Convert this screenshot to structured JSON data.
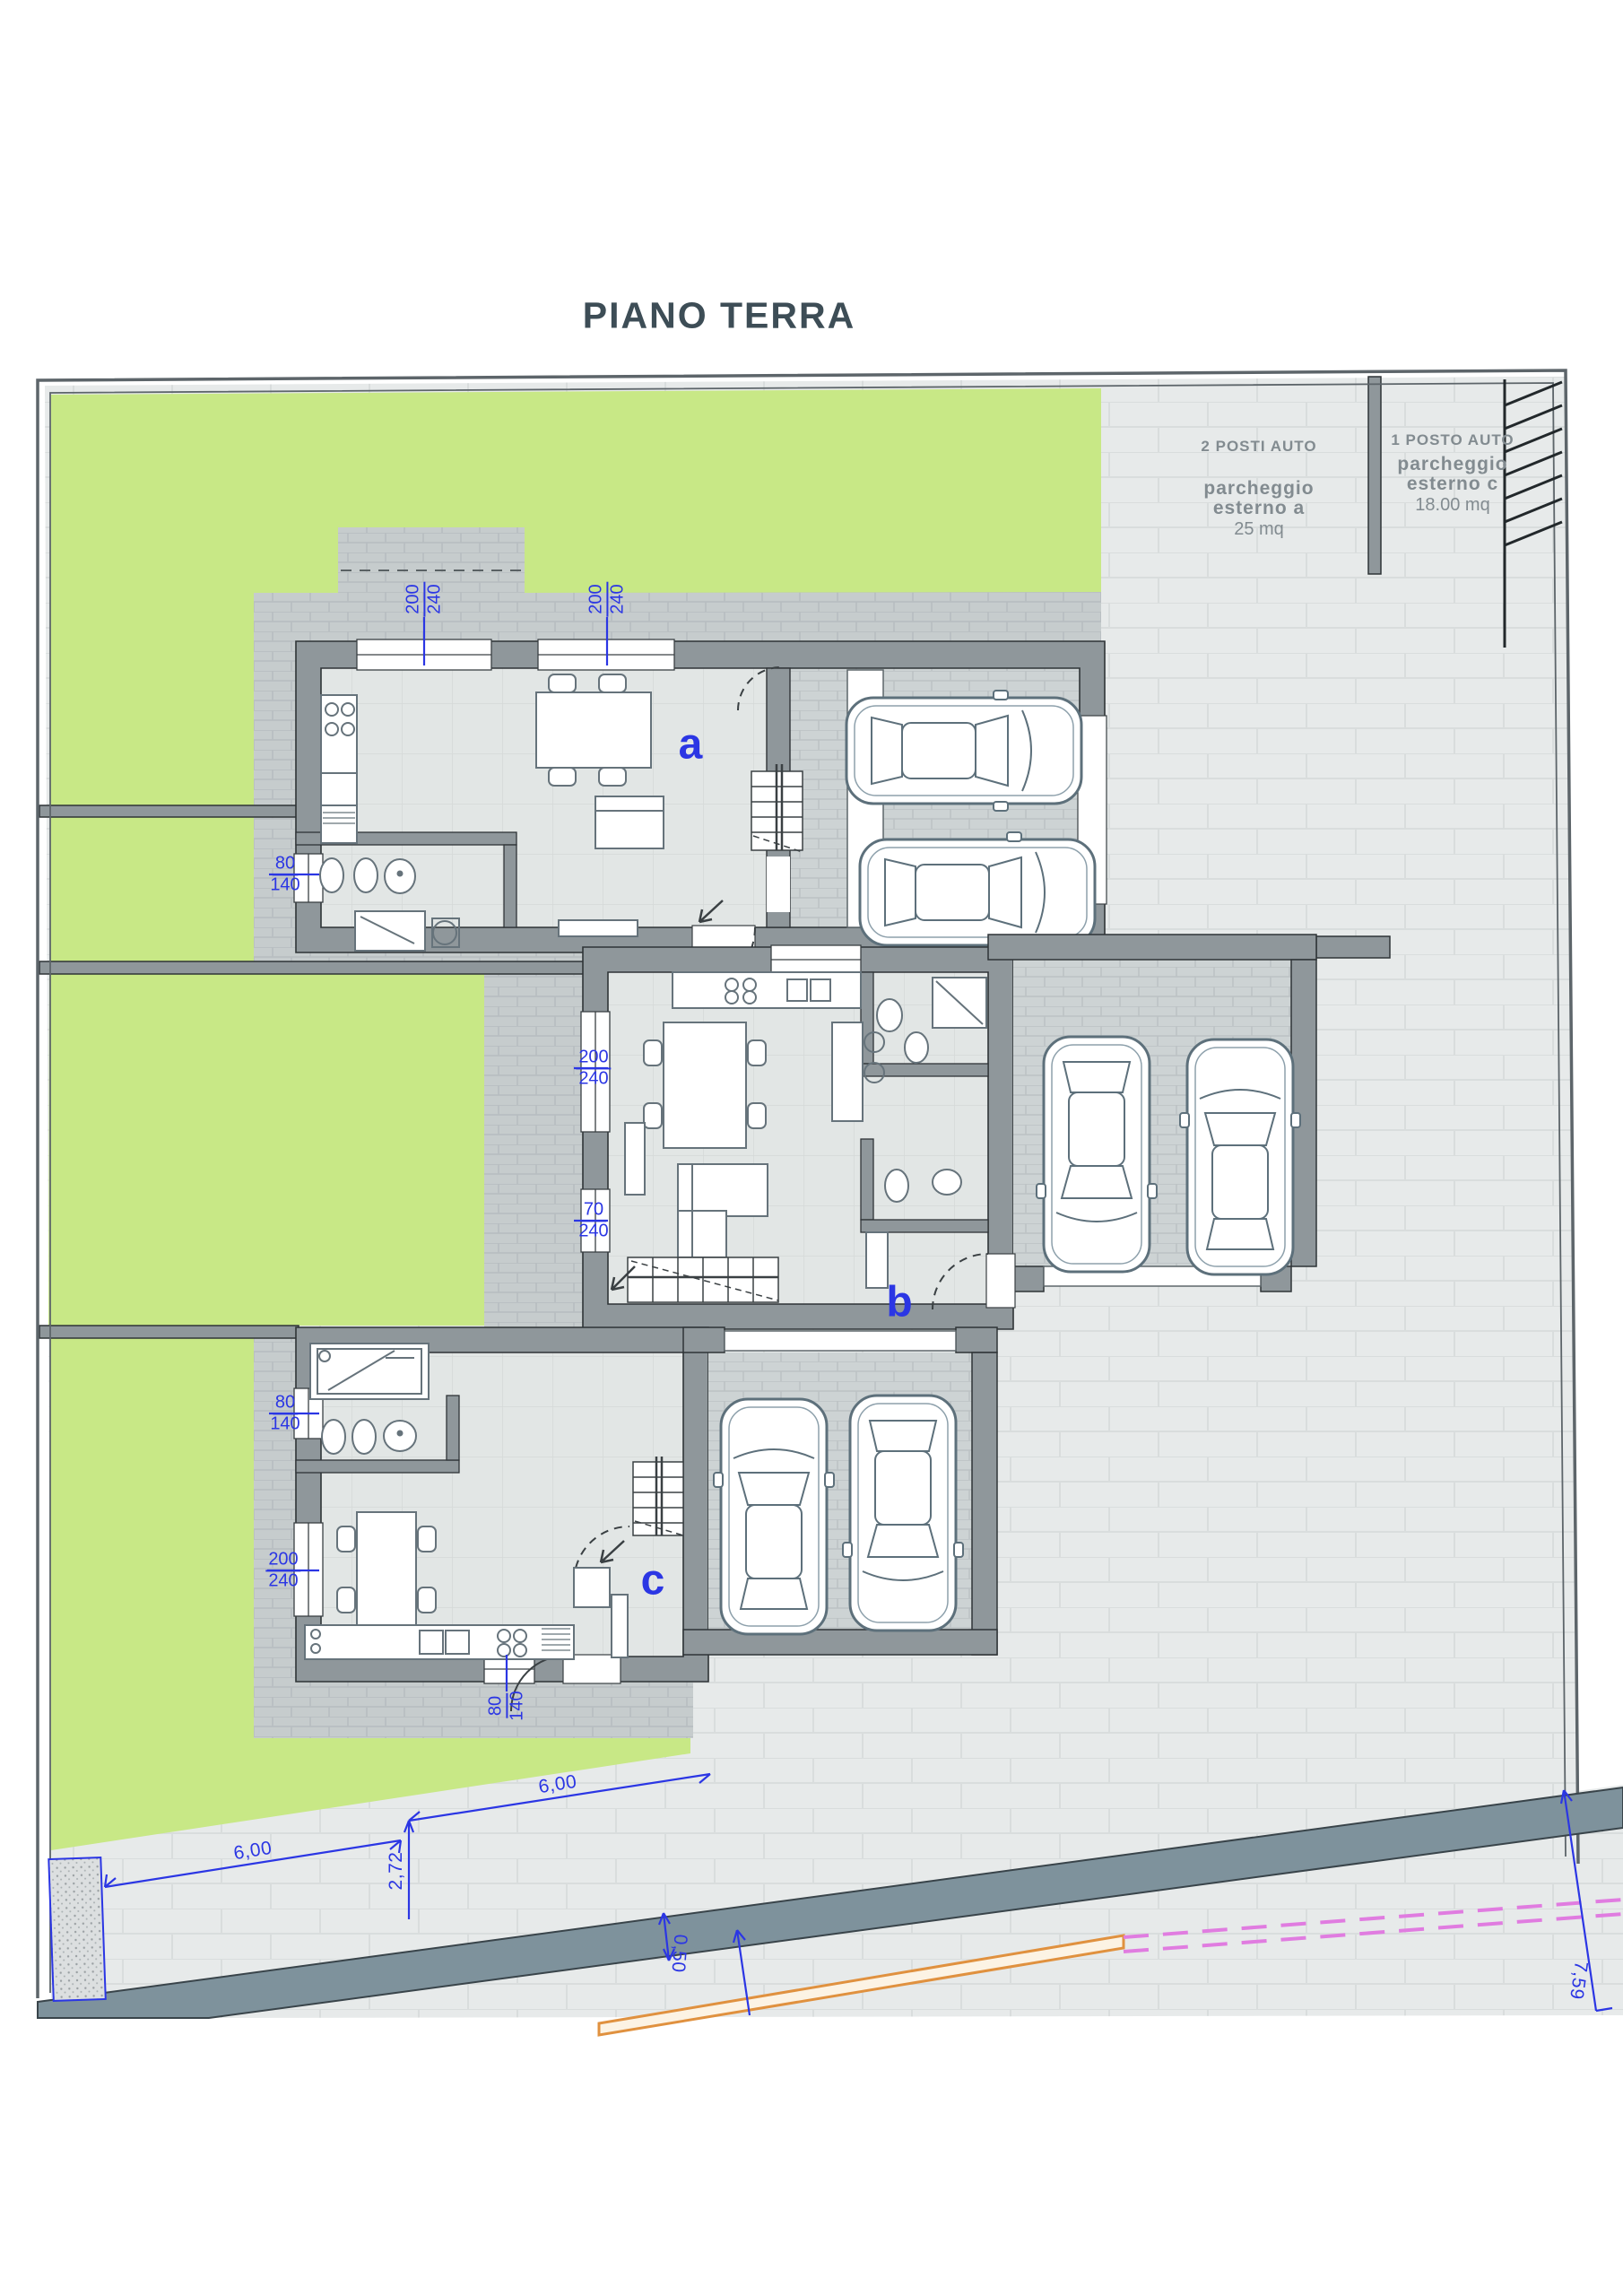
{
  "title": "PIANO TERRA",
  "unit_labels": {
    "a": "a",
    "b": "b",
    "c": "c"
  },
  "parking_a": {
    "posti": "2 POSTI AUTO",
    "line1": "parcheggio",
    "line2": "esterno a",
    "area": "25 mq"
  },
  "parking_c": {
    "posti": "1 POSTO AUTO",
    "line1": "parcheggio",
    "line2": "esterno c",
    "area": "18.00 mq"
  },
  "window_dims": {
    "a_top_left": {
      "w": "200",
      "h": "240"
    },
    "a_top_right": {
      "w": "200",
      "h": "240"
    },
    "a_bath": {
      "w": "80",
      "h": "140"
    },
    "b_living": {
      "w": "200",
      "h": "240"
    },
    "b_small": {
      "w": "70",
      "h": "240"
    },
    "c_bath": {
      "w": "80",
      "h": "140"
    },
    "c_living": {
      "w": "200",
      "h": "240"
    },
    "c_kitchen": {
      "w": "80",
      "h": "140"
    }
  },
  "site_dims": {
    "front_a": "6,00",
    "front_b": "6,00",
    "depth": "2,72",
    "road_width": "0,50",
    "side": "7,59"
  },
  "colors": {
    "lawn": "#c8e886",
    "paving_light": "#e7eaea",
    "paving_cobble": "#c6cccd",
    "garage_floor": "#cdd3d4",
    "floor": "#e2e6e5",
    "wall": "#8f979b",
    "wall_edge": "#2f3437",
    "road": "#7e929c",
    "blue": "#2b36e4",
    "orange": "#e0913f",
    "magenta": "#e07ce0",
    "title": "#3d4d56",
    "parking_text": "#828b90",
    "furniture": "#66737b",
    "boundary": "#5d656a"
  }
}
